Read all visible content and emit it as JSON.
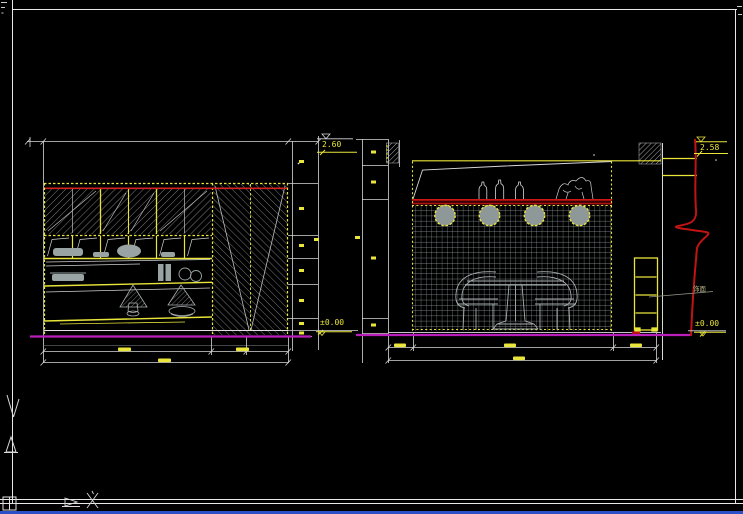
{
  "canvas": {
    "type": "cad-drawing-viewport",
    "background": "#000000",
    "paper_frame_color": "#e8e8e8",
    "status_strip_color": "#2d50c8"
  },
  "drawing": {
    "views": [
      {
        "id": "left-elevation",
        "kind": "cabinet wall elevation",
        "levels": {
          "top": "2.60",
          "bottom": "±0.00"
        }
      },
      {
        "id": "right-elevation",
        "kind": "dining wall elevation",
        "levels": {
          "top": "2.58",
          "bottom": "±0.00"
        },
        "material_note": "饰面"
      }
    ]
  },
  "colors": {
    "dimension_yellow": "#e9e53a",
    "line_white": "#e0e0e0",
    "accent_red": "#d01616",
    "baseline_magenta": "#bb1fbb",
    "furniture_gray": "#a8b0b0",
    "tile_grid_gray": "#9aa4a4"
  },
  "icons": {
    "ucs-y-axis-icon": "down arrow on left margin",
    "corner-grid-icon": "2x2 square, bottom-left paper corner",
    "flag-icon": "pennant glyph on bottom border",
    "cross-mark-icon": "X glyph on bottom border"
  }
}
